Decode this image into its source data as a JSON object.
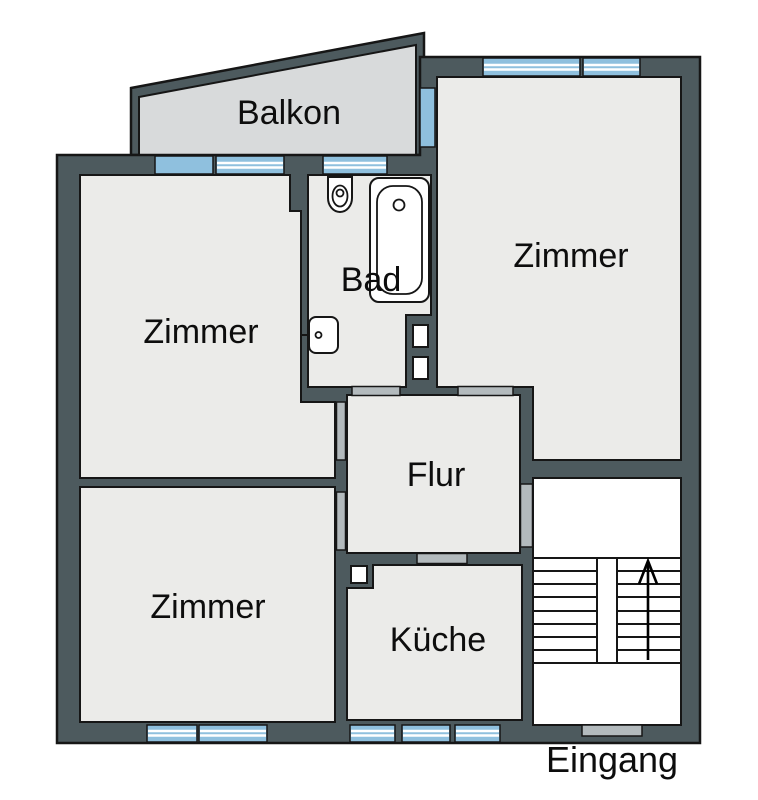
{
  "plan": {
    "type": "apartment-floor-plan",
    "language": "de"
  },
  "rooms": {
    "balkon": {
      "label": "Balkon"
    },
    "zimmer_top_right": {
      "label": "Zimmer"
    },
    "bad": {
      "label": "Bad"
    },
    "zimmer_top_left": {
      "label": "Zimmer"
    },
    "flur": {
      "label": "Flur"
    },
    "zimmer_bottom_left": {
      "label": "Zimmer"
    },
    "kueche": {
      "label": "Küche"
    },
    "eingang": {
      "label": "Eingang"
    }
  },
  "colors": {
    "wall": "#4d5a5e",
    "floor": "#ebebe9",
    "balcony": "#d8dadb",
    "window": "#8fc0de",
    "door": "#b3babd",
    "outline": "#161616"
  }
}
